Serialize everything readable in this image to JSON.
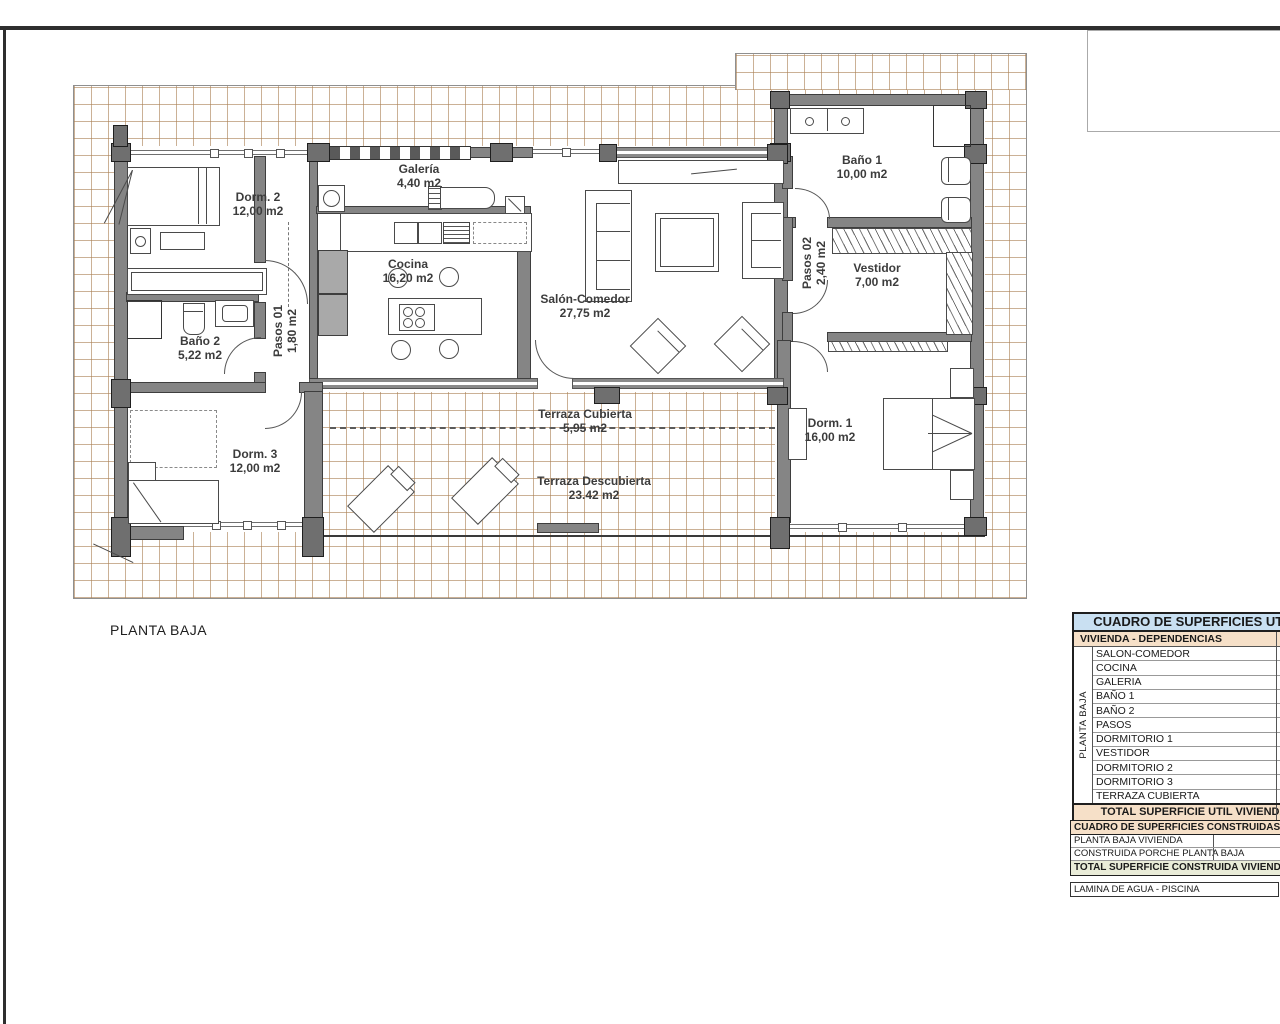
{
  "sheet": {
    "plan_title": "PLANTA BAJA"
  },
  "rooms": [
    {
      "name": "Dorm. 2",
      "area": "12,00 m2"
    },
    {
      "name": "Galería",
      "area": "4,40 m2"
    },
    {
      "name": "Cocina",
      "area": "16,20 m2"
    },
    {
      "name": "Salón-Comedor",
      "area": "27,75 m2"
    },
    {
      "name": "Baño 1",
      "area": "10,00 m2"
    },
    {
      "name": "Pasos 02",
      "area": "2,40 m2"
    },
    {
      "name": "Vestidor",
      "area": "7,00 m2"
    },
    {
      "name": "Pasos 01",
      "area": "1,80 m2"
    },
    {
      "name": "Baño 2",
      "area": "5,22 m2"
    },
    {
      "name": "Dorm. 3",
      "area": "12,00 m2"
    },
    {
      "name": "Terraza Cubierta",
      "area": "5,95 m2"
    },
    {
      "name": "Terraza Descubierta",
      "area": "23.42 m2"
    },
    {
      "name": "Dorm. 1",
      "area": "16,00 m2"
    }
  ],
  "tables": {
    "util": {
      "title": "CUADRO DE SUPERFICIES UTIL",
      "group_header": "VIVIENDA - DEPENDENCIAS",
      "side_label": "PLANTA BAJA",
      "rows": [
        "SALON-COMEDOR",
        "COCINA",
        "GALERIA",
        "BAÑO 1",
        "BAÑO 2",
        "PASOS",
        "DORMITORIO 1",
        "VESTIDOR",
        "DORMITORIO 2",
        "DORMITORIO 3",
        "TERRAZA CUBIERTA"
      ],
      "total": "TOTAL SUPERFICIE UTIL VIVIENDA"
    },
    "built": {
      "title": "CUADRO DE SUPERFICIES CONSTRUIDAS (m2)",
      "rows": [
        "PLANTA BAJA VIVIENDA",
        "CONSTRUIDA PORCHE PLANTA BAJA"
      ],
      "total": "TOTAL SUPERFICIE CONSTRUIDA VIVIENDA",
      "extra": "LAMINA DE AGUA - PISCINA"
    }
  },
  "colors": {
    "header_blue": "#c9e0f2",
    "peach": "#f6e0c8",
    "sage": "#e9ecd8",
    "hatch_line": "#ab8156",
    "wall_gray": "#858585"
  }
}
